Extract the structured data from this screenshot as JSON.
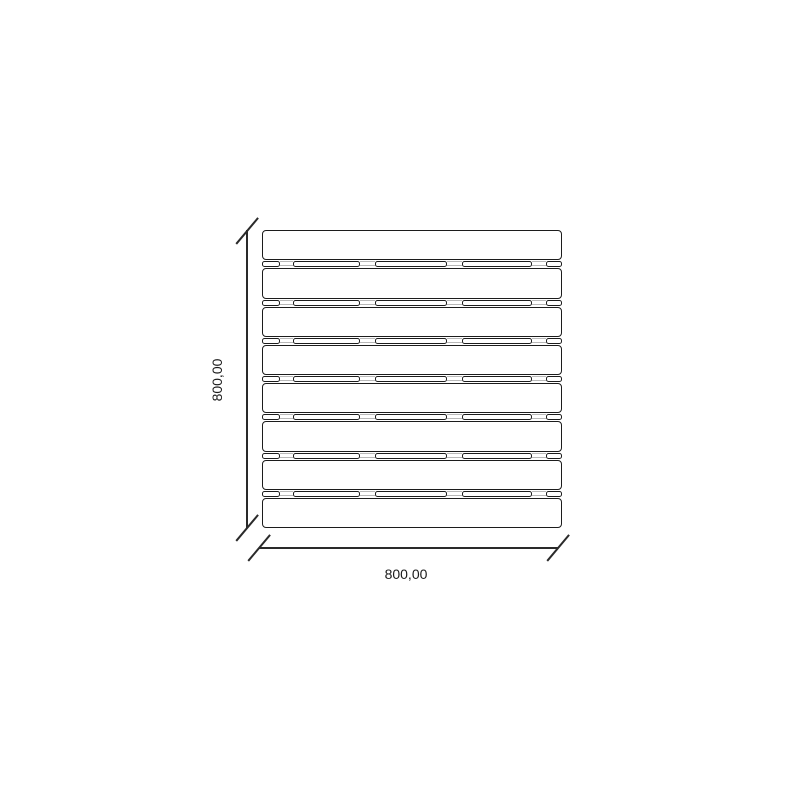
{
  "drawing": {
    "slat_count": 8,
    "gap_count": 7,
    "dimension_width": {
      "label": "800,00"
    },
    "dimension_height": {
      "label": "800,00"
    },
    "colors": {
      "line": "#1c1c1c",
      "fill": "#ffffff",
      "hidden_line": "#b8b8b8",
      "background": "#ffffff"
    },
    "geometry": {
      "board_left": 262,
      "board_top": 230,
      "board_width": 300,
      "board_height": 298,
      "gap_height": 8,
      "gap_segments": [
        [
          0,
          18
        ],
        [
          31,
          67
        ],
        [
          113,
          72
        ],
        [
          200,
          70
        ],
        [
          284,
          16
        ]
      ],
      "gap_breaks": [
        [
          18,
          13
        ],
        [
          98,
          15
        ],
        [
          185,
          15
        ],
        [
          270,
          14
        ]
      ]
    }
  }
}
